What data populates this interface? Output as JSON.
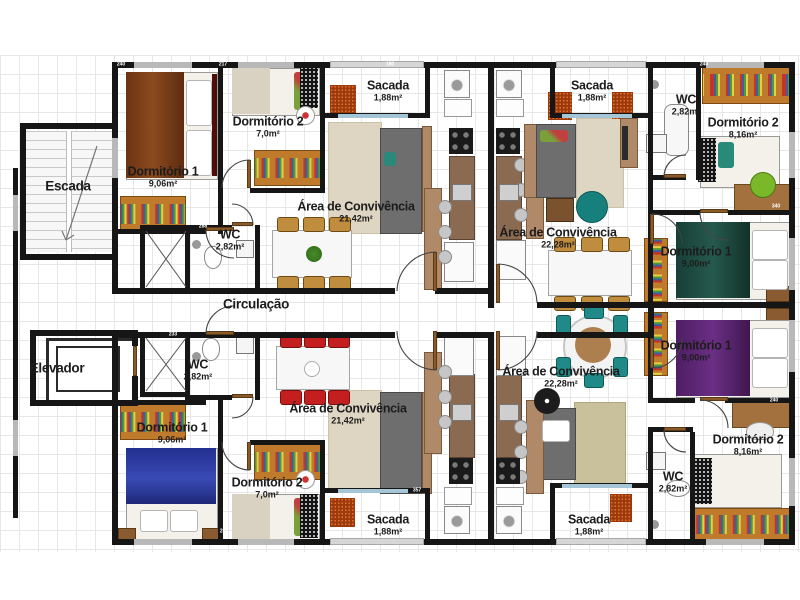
{
  "common": {
    "escada": {
      "name": "Escada"
    },
    "elevador": {
      "name": "Elevador"
    },
    "circulacao": {
      "name": "Circulação"
    }
  },
  "rooms": {
    "tl_d1": {
      "name": "Dormitório 1",
      "area": "9,06m²"
    },
    "tl_d2": {
      "name": "Dormitório 2",
      "area": "7,0m²"
    },
    "tl_wc": {
      "name": "WC",
      "area": "2,82m²"
    },
    "tl_conv": {
      "name": "Área de Convivência",
      "area": "21,42m²"
    },
    "tl_sacada": {
      "name": "Sacada",
      "area": "1,88m²"
    },
    "tr_sacada": {
      "name": "Sacada",
      "area": "1,88m²"
    },
    "tr_wc": {
      "name": "WC",
      "area": "2,82m²"
    },
    "tr_d2": {
      "name": "Dormitório 2",
      "area": "8,16m²"
    },
    "tr_conv": {
      "name": "Área de Convivência",
      "area": "22,28m²"
    },
    "tr_d1": {
      "name": "Dormitório 1",
      "area": "9,00m²"
    },
    "br_d1": {
      "name": "Dormitório 1",
      "area": "9,00m²"
    },
    "br_conv": {
      "name": "Área de Convivência",
      "area": "22,28m²"
    },
    "br_d2": {
      "name": "Dormitório 2",
      "area": "8,16m²"
    },
    "br_wc": {
      "name": "WC",
      "area": "2,82m²"
    },
    "br_sacada": {
      "name": "Sacada",
      "area": "1,88m²"
    },
    "bl_wc": {
      "name": "WC",
      "area": "2,82m²"
    },
    "bl_d1": {
      "name": "Dormitório 1",
      "area": "9,06m²"
    },
    "bl_d2": {
      "name": "Dormitório 2",
      "area": "7,0m²"
    },
    "bl_conv": {
      "name": "Área de Convivência",
      "area": "21,42m²"
    },
    "bl_sacada": {
      "name": "Sacada",
      "area": "1,88m²"
    }
  },
  "dimensions": [
    {
      "text": "240",
      "x": 121,
      "y": 65
    },
    {
      "text": "217",
      "x": 223,
      "y": 65
    },
    {
      "text": "180",
      "x": 390,
      "y": 65
    },
    {
      "text": "240",
      "x": 704,
      "y": 65
    },
    {
      "text": "112",
      "x": 417,
      "y": 112
    },
    {
      "text": "340",
      "x": 776,
      "y": 207
    },
    {
      "text": "188",
      "x": 634,
      "y": 401
    },
    {
      "text": "240",
      "x": 774,
      "y": 401
    },
    {
      "text": "288",
      "x": 203,
      "y": 227
    },
    {
      "text": "233",
      "x": 173,
      "y": 335
    },
    {
      "text": "257",
      "x": 224,
      "y": 532
    },
    {
      "text": "357",
      "x": 417,
      "y": 491
    }
  ],
  "colors": {
    "wall": "#161616",
    "grid": "#e7e7e7",
    "wardrobe": "#c07a2c",
    "duvet_brown": "#8c4a1e",
    "duvet_blue": "#3a4ab5",
    "duvet_green": "#26594d",
    "duvet_purple": "#6b2f85",
    "chair_tan": "#c08c3e",
    "chair_red": "#c41f1f",
    "chair_teal": "#1f8a87",
    "rug": "#ded6c2",
    "mat": "#9c3a0e"
  }
}
